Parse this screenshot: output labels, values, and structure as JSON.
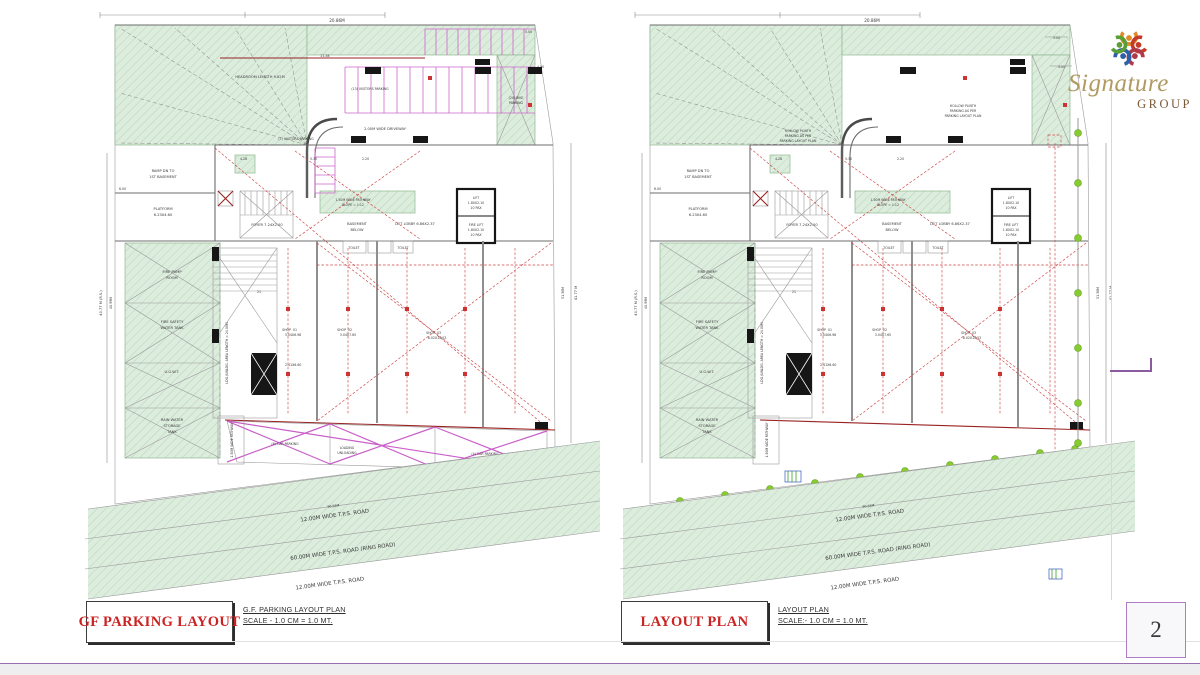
{
  "page_number": "2",
  "logo": {
    "brand": "Signature",
    "group": "GROUP"
  },
  "titles": {
    "left_box": "GF PARKING LAYOUT",
    "left_caption": "G.F. PARKING LAYOUT PLAN",
    "left_scale": "SCALE - 1.0 CM = 1.0 MT.",
    "right_box": "LAYOUT PLAN",
    "right_caption": "LAYOUT PLAN",
    "right_scale": "SCALE:- 1.0 CM = 1.0 MT."
  },
  "roads": {
    "r1": "12.00M WIDE T.P.S. ROAD",
    "r2": "60.00M WIDE T.P.S. ROAD (RING ROAD)",
    "r3": "12.00M WIDE T.P.S. ROAD"
  },
  "shared": {
    "ramp1": "RAMP DN TO",
    "ramp2": "1ST BASEMENT",
    "platform1": "PLATFORM",
    "platform2": "6.23X4.60",
    "foyer": "FOYER 7.24X2.00",
    "basement1": "BASEMENT",
    "basement2": "BELOW",
    "lobby": "LIFT LOBBY 6.86X2.37",
    "lift": "LIFT",
    "fire_lift": "FIRE LIFT",
    "lift_size": "1.80X2.10",
    "lift_cap": "10 PAX",
    "pathway1": "1.50M WIDE PATHWAY",
    "pathway2": "SLOPE = 1:12",
    "pathway_box": "1.50M WIDE PATHWAY",
    "fire_pump1": "FIRE PUMP",
    "fire_pump2": "ROOM",
    "fire_tank1": "FIRE SAFETY",
    "fire_tank2": "WATER TANK",
    "ugwt": "U.G.W.T.",
    "rain1": "RAIN WATER",
    "rain2": "STORAGE",
    "rain3": "TANK",
    "ldg": "LDG./UNLDG. AREA LENGTH = 24.00M",
    "shop": "SHOP",
    "shop1_no": "01",
    "shop2_no": "02",
    "shop3_no": "03",
    "shop1_size": "3.04X6.98",
    "shop2_size": "3.04X7.65",
    "shop3_size": "8.02X10.03",
    "stair_size": "2.41X6.60",
    "steps": "21",
    "headroom": "HEADROOM LENGTH 9.62M",
    "driveway": "2.00M WIDE DRIVEWAY",
    "visitors7": "(7) VISITORS PARKING",
    "visitors13": "(13) VISITORS PARKING",
    "bike1": "(20) BIKE",
    "bike2": "PARKING",
    "toilet": "TOILET",
    "dim_top": "20.86M",
    "dim_2158": "21.58",
    "dim_428": "4.28",
    "dim_530": "5.30",
    "dim_220": "2.20",
    "dim_600": "6.00",
    "dim_400": "4.00",
    "dim_300": "3.00",
    "dim_500": "5.00",
    "side_left1": "40.77 M (R.S.)",
    "side_left2": "40.99M",
    "side_right1": "41.77 M",
    "side_right2": "51.38M",
    "road_len": "90.58M"
  },
  "left_only": {
    "cars6": "(6) CAR PARKING",
    "loading1": "LOADING",
    "loading2": "UNLOADING",
    "cars4": "(4) CAR PARKING"
  },
  "right_only": {
    "hollow1": "HOLLOW PLINTH",
    "hollow2": "PARKING AS PER",
    "hollow3": "PARKING LAYOUT PLAN"
  },
  "colors": {
    "title_red": "#cc2222",
    "plan_green": "#dcecdd",
    "stall_magenta": "#cc66cc",
    "grid_red": "#cc3333",
    "footer_purple": "#9b6fae",
    "logo_gold": "#b09a62"
  }
}
